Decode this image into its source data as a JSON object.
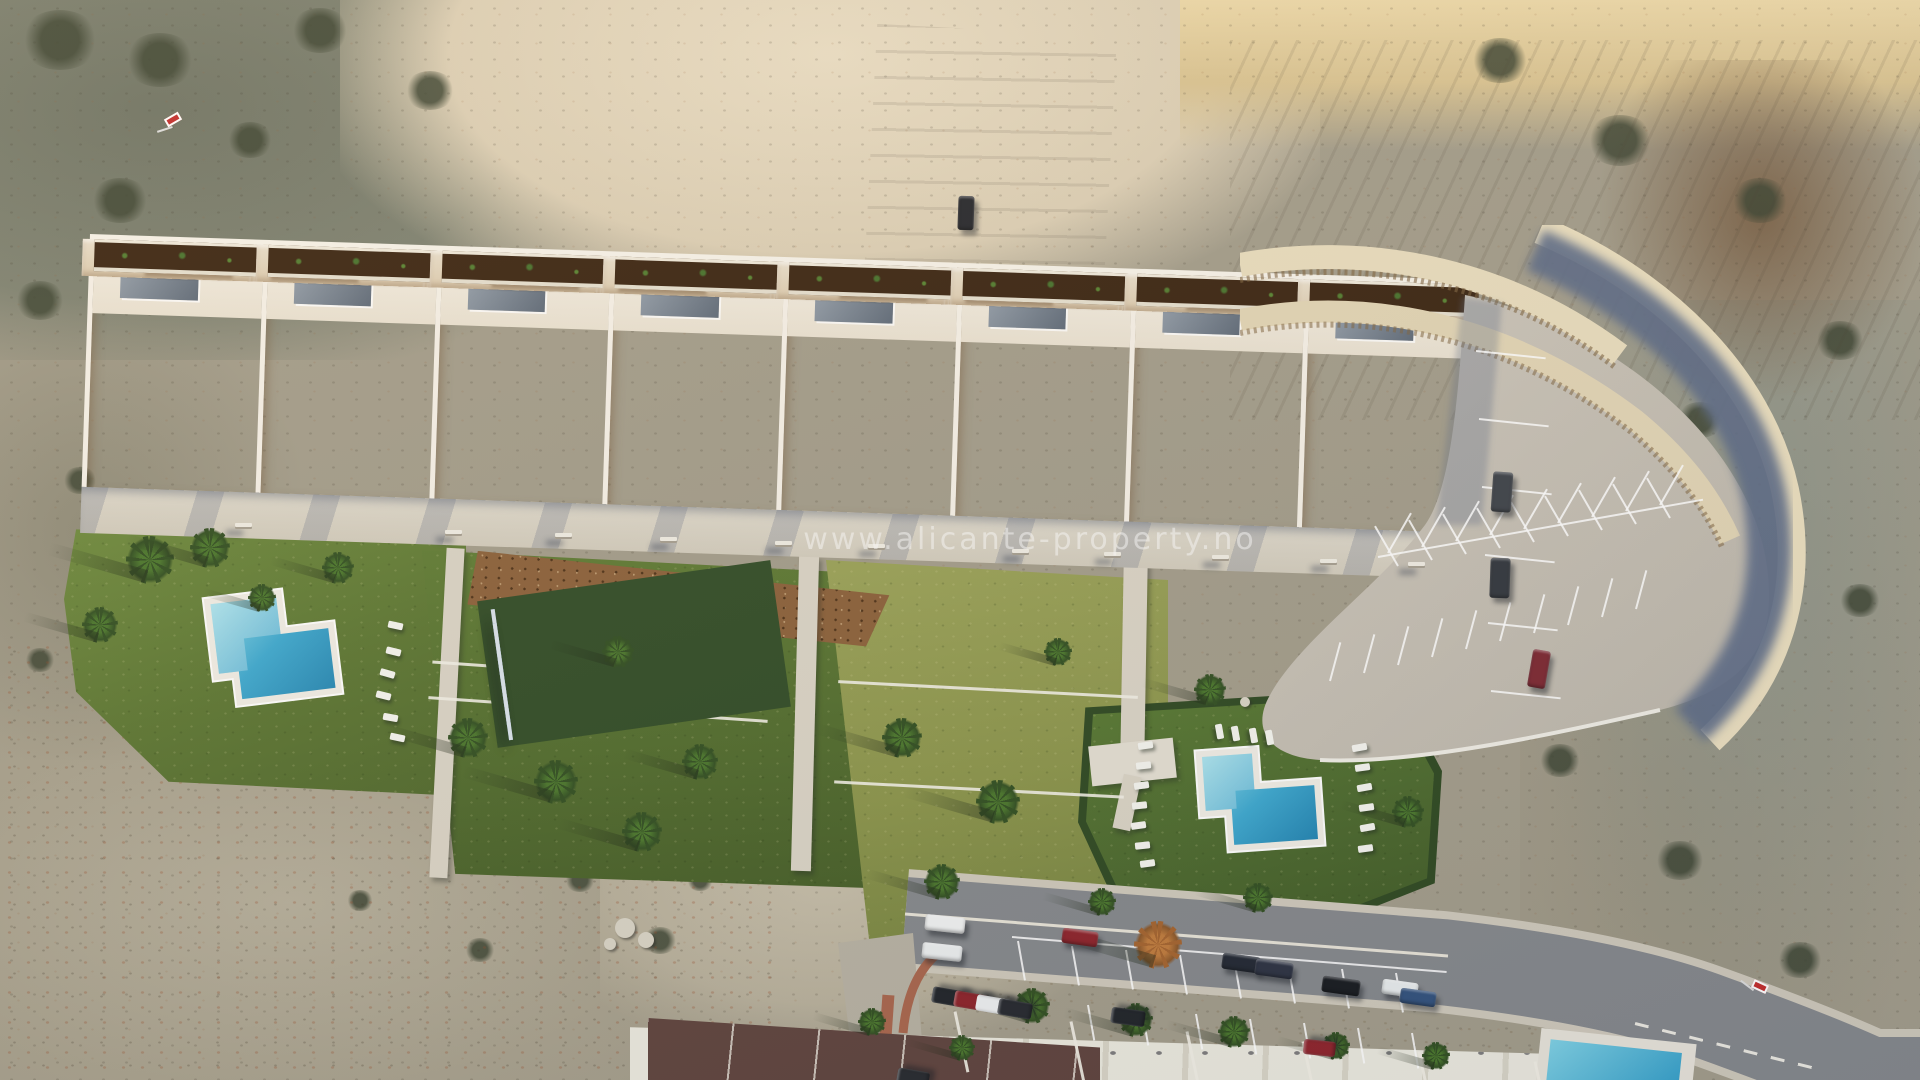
{
  "watermark": {
    "text": "www.alicante-property.no"
  },
  "scene": {
    "description": "Aerial render of a terraced white apartment complex on a desert hillside with two L-shaped pools, two padel courts, gardens, a curved parking lot, and a residential street below",
    "building_blocks": 8,
    "pools": 2,
    "padel_courts": 2
  },
  "palette": {
    "sand": "#d9cdb4",
    "sandBright": "#e8dcc2",
    "scrub": "#98927f",
    "scrubDark": "#6e7465",
    "lawn": "#5a7530",
    "lawnWild": "#8a9449",
    "water": "#3aa8d0",
    "waterShallow": "#8edbea",
    "court": "#46729f",
    "cream": "#efe8da",
    "pergola": "#cf9f72",
    "planter": "#38220f",
    "walk": "#d9d3c5",
    "parking": "#c9c3b8",
    "road": "#84878b",
    "wallShadow": "#5c6a86",
    "hedge": "#2c471f",
    "roofGlass": "#76828f",
    "mulch": "#8a5f38"
  },
  "objects": {
    "palms_format": "[x, y, radius, variant]",
    "palms": [
      [
        150,
        560,
        24,
        "g"
      ],
      [
        210,
        548,
        20,
        "g"
      ],
      [
        100,
        625,
        18,
        "g"
      ],
      [
        338,
        568,
        16,
        "g"
      ],
      [
        262,
        598,
        14,
        "g"
      ],
      [
        468,
        738,
        20,
        "g"
      ],
      [
        556,
        782,
        22,
        "g"
      ],
      [
        642,
        832,
        20,
        "g"
      ],
      [
        618,
        652,
        16,
        "g"
      ],
      [
        700,
        762,
        18,
        "g"
      ],
      [
        902,
        738,
        20,
        "g"
      ],
      [
        998,
        802,
        22,
        "g"
      ],
      [
        942,
        882,
        18,
        "g"
      ],
      [
        1058,
        652,
        14,
        "g"
      ],
      [
        1210,
        690,
        16,
        "g"
      ],
      [
        1408,
        812,
        16,
        "g"
      ],
      [
        1258,
        898,
        15,
        "g"
      ],
      [
        1102,
        902,
        14,
        "g"
      ],
      [
        1032,
        1006,
        18,
        "g"
      ],
      [
        1136,
        1020,
        17,
        "g"
      ],
      [
        1234,
        1032,
        16,
        "g"
      ],
      [
        872,
        1022,
        14,
        "g"
      ],
      [
        1336,
        1046,
        14,
        "g"
      ],
      [
        962,
        1048,
        13,
        "g"
      ],
      [
        1436,
        1056,
        14,
        "g"
      ],
      [
        1158,
        945,
        24,
        "autumn"
      ]
    ],
    "bushes_format": "[x, y, radius]",
    "bushes": [
      [
        60,
        40,
        40
      ],
      [
        160,
        60,
        36
      ],
      [
        320,
        30,
        30
      ],
      [
        430,
        90,
        26
      ],
      [
        120,
        200,
        30
      ],
      [
        40,
        300,
        26
      ],
      [
        250,
        140,
        24
      ],
      [
        1500,
        60,
        30
      ],
      [
        1620,
        140,
        34
      ],
      [
        1760,
        200,
        30
      ],
      [
        1840,
        340,
        26
      ],
      [
        1700,
        420,
        24
      ],
      [
        1860,
        600,
        22
      ],
      [
        1560,
        760,
        22
      ],
      [
        1680,
        860,
        26
      ],
      [
        1800,
        960,
        24
      ],
      [
        660,
        940,
        18
      ],
      [
        580,
        880,
        16
      ],
      [
        700,
        880,
        14
      ],
      [
        480,
        950,
        16
      ],
      [
        360,
        900,
        14
      ],
      [
        80,
        480,
        18
      ],
      [
        40,
        660,
        16
      ]
    ],
    "loungers_format": "[x, y, rotation_deg]",
    "loungers": [
      [
        388,
        622,
        12
      ],
      [
        386,
        648,
        14
      ],
      [
        380,
        670,
        16
      ],
      [
        376,
        692,
        14
      ],
      [
        383,
        714,
        10
      ],
      [
        390,
        734,
        12
      ],
      [
        1138,
        742,
        -8
      ],
      [
        1136,
        762,
        -6
      ],
      [
        1134,
        782,
        -8
      ],
      [
        1132,
        802,
        -6
      ],
      [
        1131,
        822,
        -8
      ],
      [
        1135,
        842,
        -6
      ],
      [
        1140,
        860,
        -8
      ],
      [
        1352,
        744,
        -10
      ],
      [
        1355,
        764,
        -8
      ],
      [
        1357,
        784,
        -10
      ],
      [
        1359,
        804,
        -8
      ],
      [
        1360,
        824,
        -10
      ],
      [
        1358,
        845,
        -8
      ],
      [
        1212,
        728,
        80
      ],
      [
        1228,
        730,
        80
      ],
      [
        1246,
        732,
        80
      ],
      [
        1262,
        734,
        80
      ]
    ],
    "benches_format": "[x, y]",
    "benches": [
      [
        235,
        523
      ],
      [
        445,
        530
      ],
      [
        555,
        533
      ],
      [
        660,
        537
      ],
      [
        775,
        541
      ],
      [
        868,
        544
      ],
      [
        1012,
        549
      ],
      [
        1104,
        552
      ],
      [
        1212,
        555
      ],
      [
        1320,
        559
      ],
      [
        1408,
        562
      ]
    ],
    "cars_format": "[x, y, rotation_deg, length, width, color]",
    "cars": [
      [
        958,
        196,
        2,
        16,
        34,
        "#23252b"
      ],
      [
        1492,
        472,
        4,
        20,
        40,
        "#3c4148"
      ],
      [
        1490,
        558,
        2,
        20,
        40,
        "#30353c"
      ],
      [
        1530,
        650,
        10,
        18,
        38,
        "#7c2630"
      ],
      [
        925,
        916,
        6,
        40,
        16,
        "#f1f3f3"
      ],
      [
        922,
        944,
        6,
        40,
        16,
        "#eceff0"
      ],
      [
        941,
        980,
        -80,
        16,
        34,
        "#1d2126"
      ],
      [
        963,
        984,
        -80,
        16,
        34,
        "#8c2027"
      ],
      [
        985,
        988,
        -80,
        16,
        34,
        "#eef0f1"
      ],
      [
        1007,
        992,
        -80,
        16,
        34,
        "#23262c"
      ],
      [
        1062,
        930,
        8,
        36,
        15,
        "#8d2028"
      ],
      [
        1222,
        955,
        8,
        38,
        16,
        "#1f2530"
      ],
      [
        1255,
        961,
        8,
        38,
        16,
        "#2a3040"
      ],
      [
        1322,
        978,
        8,
        38,
        16,
        "#15181d"
      ],
      [
        1382,
        981,
        8,
        36,
        15,
        "#e9edee"
      ],
      [
        1400,
        990,
        8,
        36,
        15,
        "#30507c"
      ],
      [
        1120,
        1000,
        -82,
        16,
        34,
        "#1d2126"
      ],
      [
        1312,
        1032,
        -84,
        15,
        32,
        "#8e2129"
      ],
      [
        905,
        1062,
        -80,
        16,
        32,
        "#24272c"
      ]
    ],
    "rocks_format": "[x, y, radius]",
    "rocks": [
      [
        625,
        928,
        10
      ],
      [
        646,
        940,
        8
      ],
      [
        610,
        944,
        6
      ],
      [
        1245,
        702,
        5
      ],
      [
        1298,
        698,
        4
      ],
      [
        1352,
        708,
        4
      ],
      [
        1270,
        735,
        4
      ]
    ],
    "line_fans_format": "[x, y, dx, dy, count, rotation_deg, length, class]",
    "line_fans": [
      [
        1476,
        350,
        3,
        68,
        6,
        6,
        70,
        "bay"
      ],
      [
        1388,
        552,
        34,
        -6,
        9,
        -60,
        46,
        "bay"
      ],
      [
        1398,
        565,
        34,
        -6,
        9,
        -120,
        46,
        "bay"
      ],
      [
        1330,
        680,
        34,
        -8,
        10,
        -75,
        40,
        "bay"
      ],
      [
        1018,
        940,
        54,
        4.6,
        8,
        80,
        40,
        "bay"
      ],
      [
        1088,
        1004,
        54,
        4.6,
        7,
        80,
        36,
        "bay"
      ],
      [
        955,
        1010,
        116,
        10,
        6,
        78,
        62,
        "wline"
      ]
    ],
    "single_lines_format": "[x, y, length, rotation_deg, class]",
    "single_lines": [
      [
        1378,
        556,
        330,
        -10,
        "bay"
      ],
      [
        1012,
        936,
        436,
        4.6,
        "bay"
      ],
      [
        1635,
        1022,
        190,
        14,
        "dashed"
      ]
    ],
    "signs_format": "[x, y, rotation_deg]",
    "signs": [
      [
        165,
        115,
        -30
      ],
      [
        1752,
        982,
        25
      ]
    ]
  }
}
